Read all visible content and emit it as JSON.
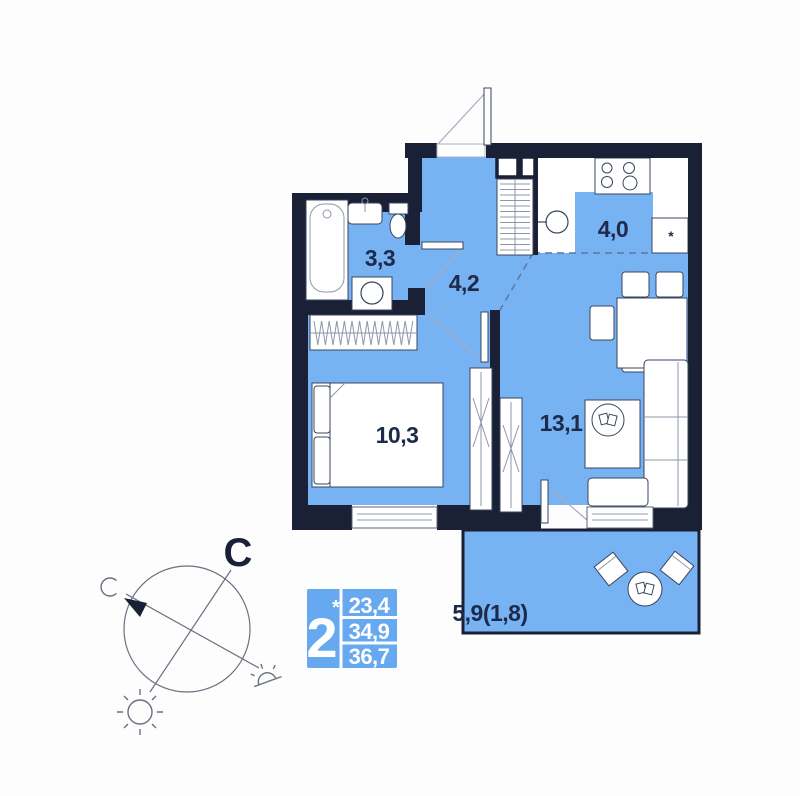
{
  "title": "2-room apartment floor plan",
  "rooms": {
    "bathroom": {
      "label": "3,3"
    },
    "hallway": {
      "label": "4,2"
    },
    "kitchen": {
      "label": "4,0"
    },
    "bedroom": {
      "label": "10,3"
    },
    "living_room": {
      "label": "13,1"
    },
    "balcony": {
      "label": "5,9(1,8)"
    }
  },
  "kitchen": {
    "fridge_mark": "*"
  },
  "compass": {
    "north": "С"
  },
  "info_badge": {
    "room_count": "2",
    "note_mark": "*",
    "areas": {
      "living": "23,4",
      "apartment": "34,9",
      "total": "36,7"
    }
  },
  "colors": {
    "floor": "#77b2f3",
    "wall": "#1a2036",
    "label": "#1e2a4a",
    "badge": "#66a9f1",
    "line": "#39445f"
  }
}
